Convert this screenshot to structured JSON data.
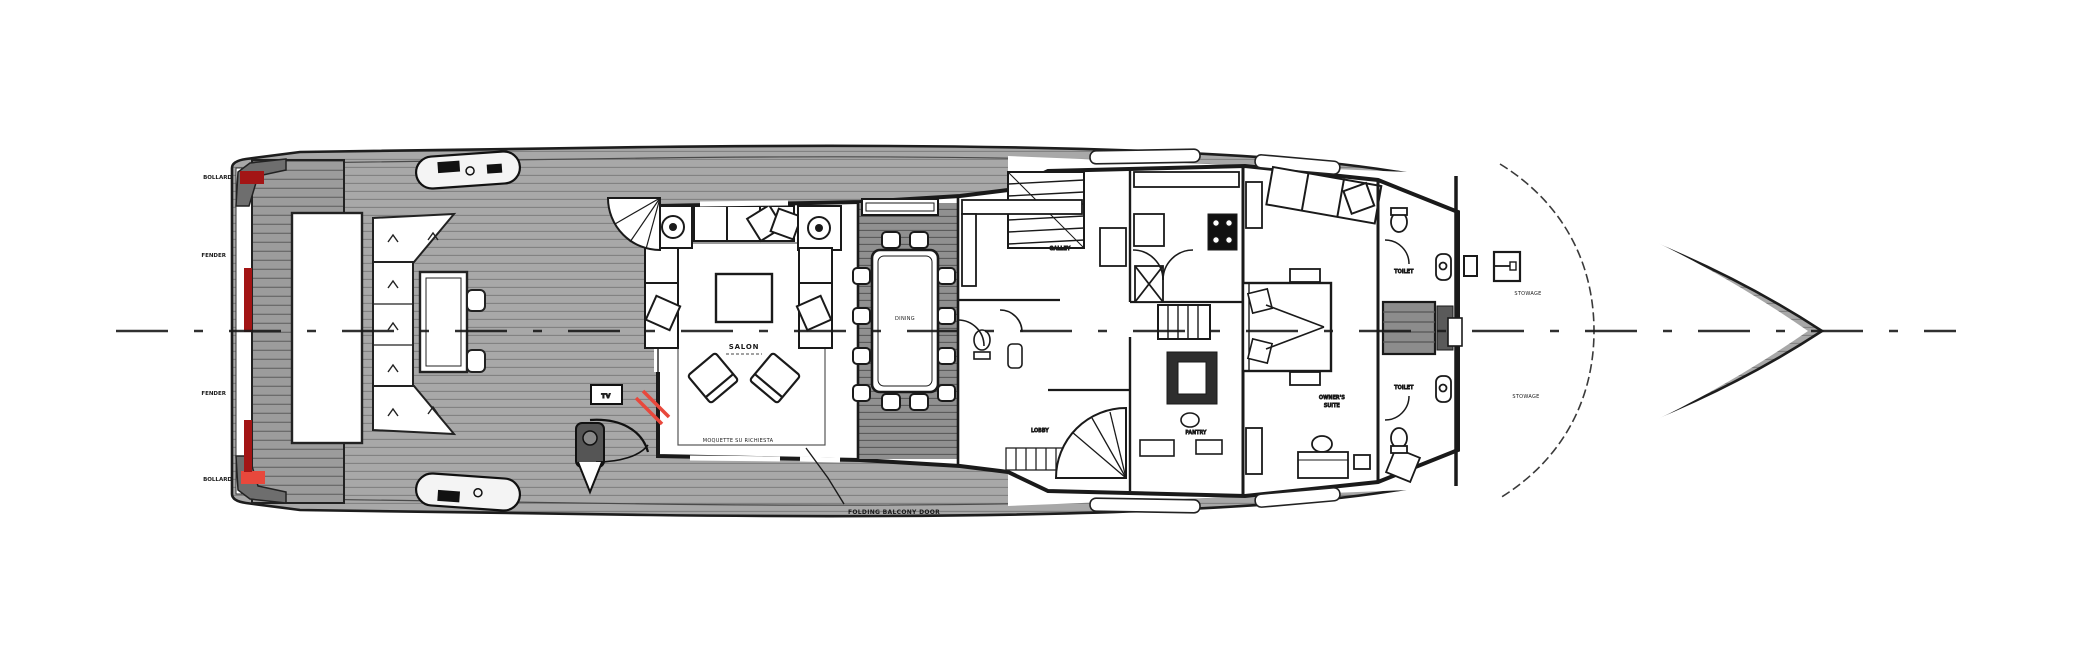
{
  "title": "Motor yacht main deck general arrangement plan",
  "colors": {
    "accent_red": "#e8483c",
    "dark_red": "#a31515",
    "ink": "#1a1a1a",
    "deck_gray": "#a8a8a8",
    "dining_floor": "#8f8f8f"
  },
  "labels": {
    "salon": "SALON",
    "salon_note": "MOQUETTE SU RICHIESTA",
    "dining": "DINING",
    "galley": "GALLEY",
    "lobby": "LOBBY",
    "pantry": "PANTRY",
    "owner1": "OWNER'S",
    "owner2": "SUITE",
    "bath_fwd": "TOILET",
    "bath_aft": "TOILET",
    "bow_fwd": "STOWAGE",
    "bow_aft": "STOWAGE",
    "tv": "TV",
    "annotation": "FOLDING BALCONY DOOR",
    "stern_marks": [
      "BOLLARD",
      "FENDER",
      "FENDER",
      "BOLLARD"
    ]
  }
}
